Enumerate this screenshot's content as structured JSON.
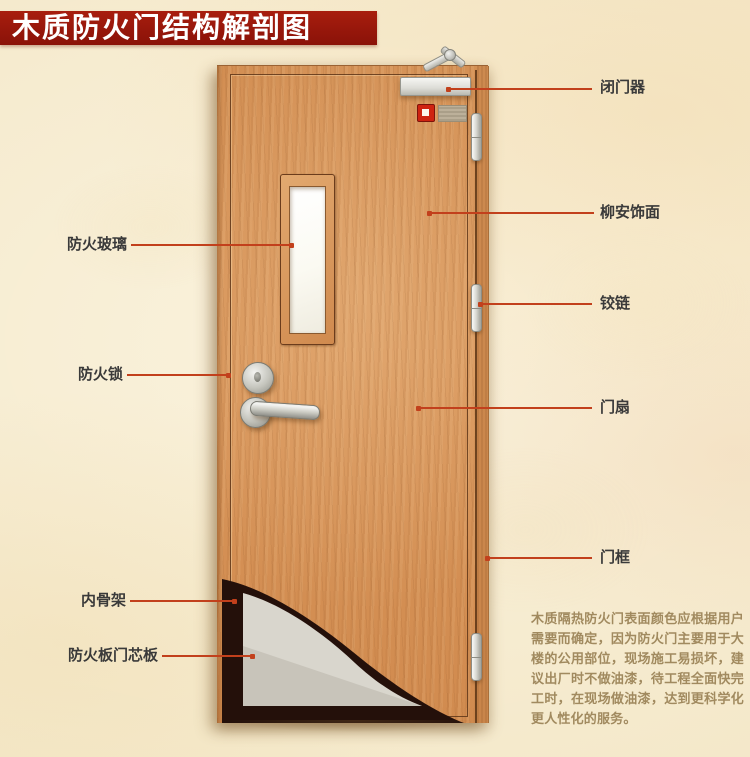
{
  "title": "木质防火门结构解剖图",
  "labels": {
    "left": [
      {
        "text": "防火玻璃"
      },
      {
        "text": "防火锁"
      },
      {
        "text": "内骨架"
      },
      {
        "text": "防火板门芯板"
      }
    ],
    "right": [
      {
        "text": "闭门器"
      },
      {
        "text": "柳安饰面"
      },
      {
        "text": "铰链"
      },
      {
        "text": "门扇"
      },
      {
        "text": "门框"
      }
    ]
  },
  "note": {
    "text": "木质隔热防火门表面颜色应根据用户需要而确定，因为防火门主要用于大楼的公用部位，现场施工易损坏，建议出厂时不做油漆，待工程全面快完工时，在现场做油漆，达到更科学化更人性化的服务。"
  },
  "colors": {
    "banner": "#97170b",
    "leader": "#c2401c",
    "label_text": "#3a3a3a",
    "note_text": "#a18a5f",
    "wood": "#d79459",
    "core_board": "#d9d6cd",
    "inner_skeleton": "#24100a"
  }
}
